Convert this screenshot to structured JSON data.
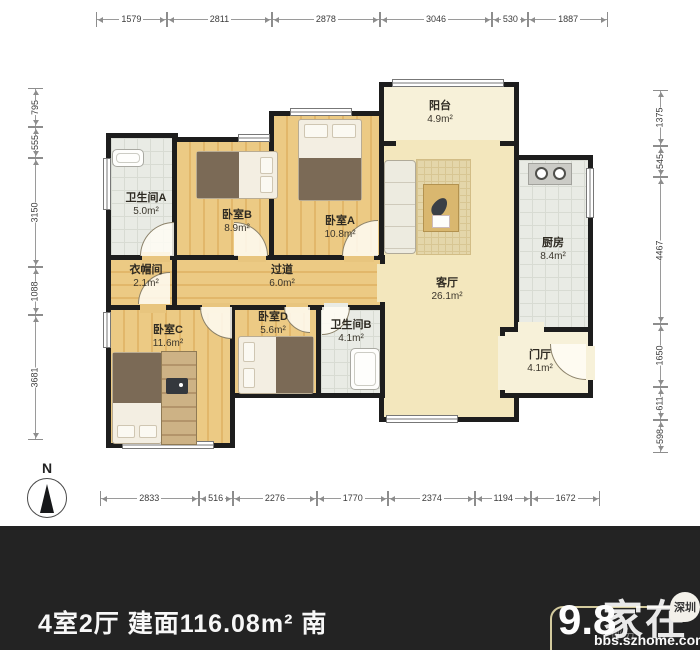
{
  "compass": {
    "label": "N"
  },
  "rooms": [
    {
      "key": "bathroom-a",
      "name": "卫生间A",
      "area": "5.0m²"
    },
    {
      "key": "bedroom-b",
      "name": "卧室B",
      "area": "8.9m²"
    },
    {
      "key": "bedroom-a",
      "name": "卧室A",
      "area": "10.8m²"
    },
    {
      "key": "balcony",
      "name": "阳台",
      "area": "4.9m²"
    },
    {
      "key": "living-room",
      "name": "客厅",
      "area": "26.1m²"
    },
    {
      "key": "kitchen",
      "name": "厨房",
      "area": "8.4m²"
    },
    {
      "key": "cloakroom",
      "name": "衣帽间",
      "area": "2.1m²"
    },
    {
      "key": "corridor",
      "name": "过道",
      "area": "6.0m²"
    },
    {
      "key": "bedroom-c",
      "name": "卧室C",
      "area": "11.6m²"
    },
    {
      "key": "bedroom-d",
      "name": "卧室D",
      "area": "5.6m²"
    },
    {
      "key": "bathroom-b",
      "name": "卫生间B",
      "area": "4.1m²"
    },
    {
      "key": "foyer",
      "name": "门厅",
      "area": "4.1m²"
    }
  ],
  "dimensions": {
    "top": [
      1579,
      2811,
      2878,
      3046,
      530,
      1887
    ],
    "bottom": [
      2833,
      516,
      2276,
      1770,
      2374,
      1194,
      1672
    ],
    "left": [
      795,
      555,
      3150,
      1088,
      3681
    ],
    "right": [
      1375,
      545,
      4467,
      1650,
      611,
      598
    ]
  },
  "footer": {
    "summary": "4室2厅 建面116.08m² 南",
    "score": "9.8",
    "score_label": "评分",
    "watermark_name": "家在",
    "watermark_badge": "深圳",
    "watermark_site": "bbs.szhome.com"
  },
  "colors": {
    "wall": "#1d1d1d",
    "wood_floor": "#e8c57e",
    "living_floor": "#f3e7bd",
    "tile_floor": "#e9ebe5",
    "bottom_bar": "#232323",
    "badge_border": "#d4cb9e"
  }
}
